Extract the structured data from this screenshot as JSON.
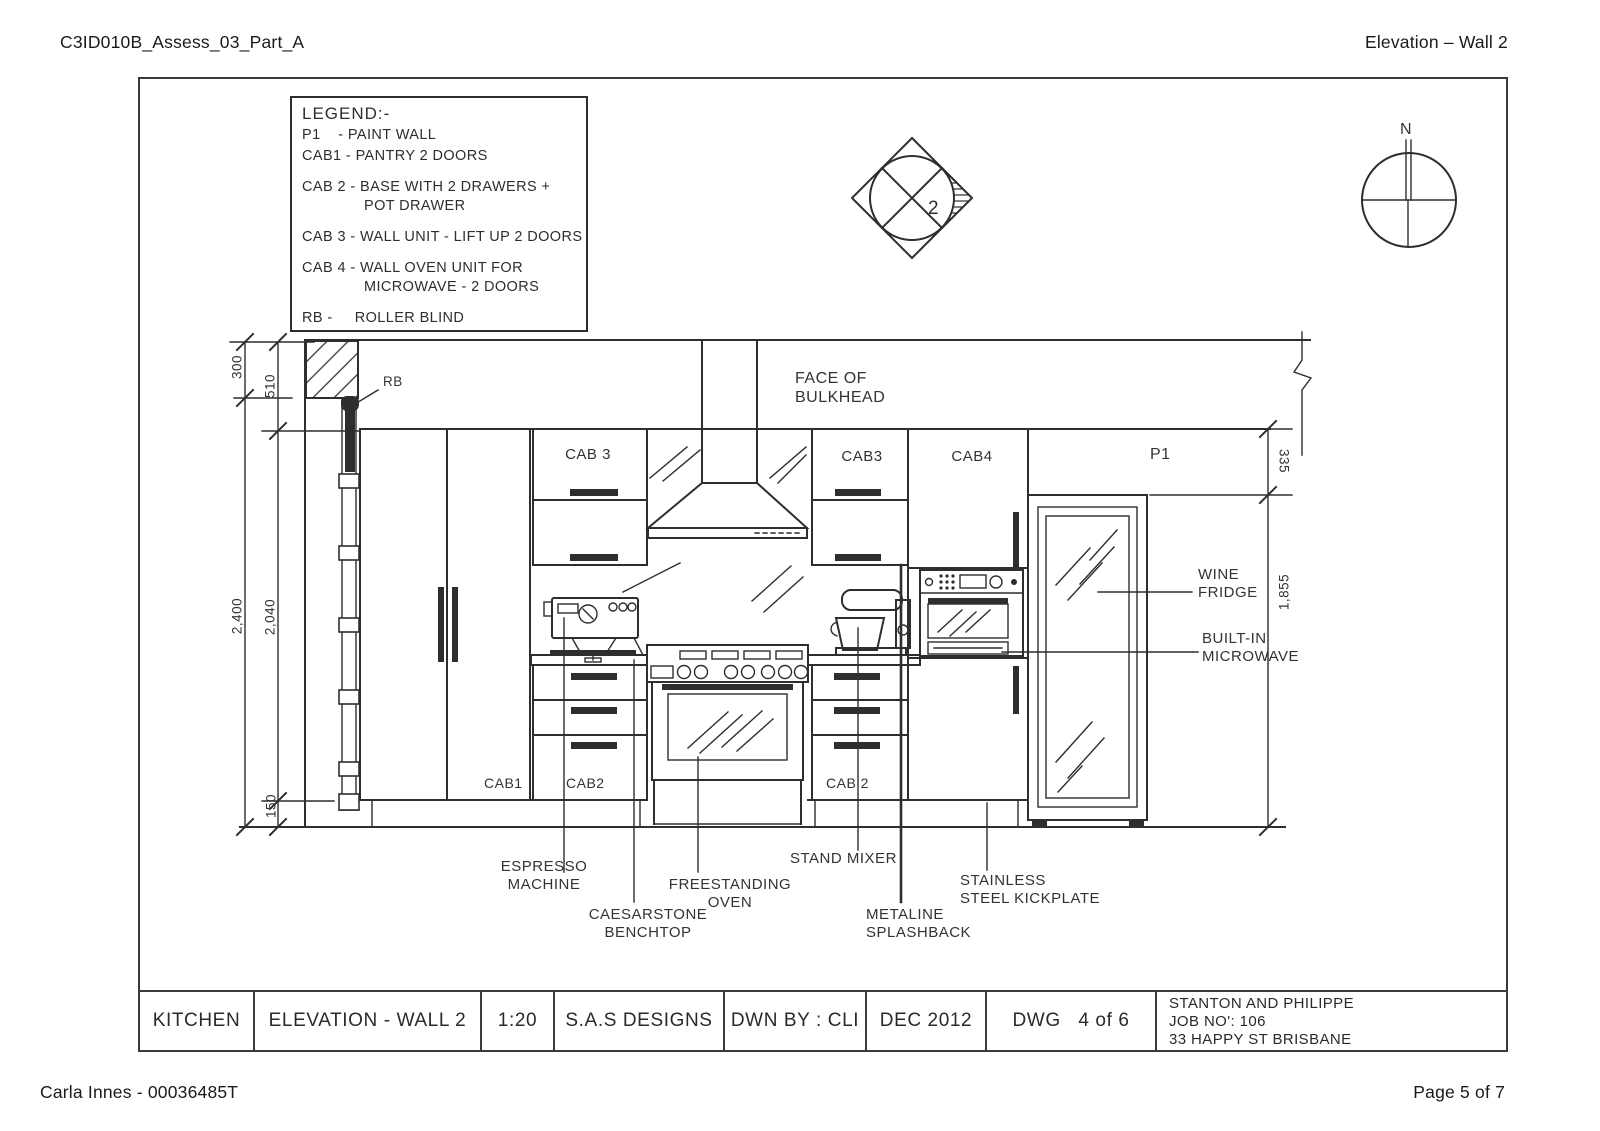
{
  "page": {
    "header_left": "C3ID010B_Assess_03_Part_A",
    "header_right": "Elevation – Wall 2",
    "footer_left": "Carla Innes - 00036485T",
    "footer_right": "Page 5 of 7"
  },
  "legend": {
    "title": "LEGEND:-",
    "entries": [
      {
        "text": "P1    - PAINT WALL"
      },
      {
        "text": "CAB1 - PANTRY 2 DOORS"
      },
      {
        "text": "CAB 2 - BASE WITH 2 DRAWERS +\n              POT DRAWER"
      },
      {
        "text": "CAB 3 - WALL UNIT - LIFT UP 2 DOORS"
      },
      {
        "text": "CAB 4 - WALL OVEN UNIT FOR\n              MICROWAVE - 2 DOORS"
      },
      {
        "text": "RB -     ROLLER BLIND"
      }
    ]
  },
  "markers": {
    "section_number": "2",
    "north_label": "N"
  },
  "dimensions": {
    "left_outer": [
      "300",
      "2,400"
    ],
    "left_inner": [
      "510",
      "2,040",
      "150"
    ],
    "right": [
      "335",
      "1,855"
    ]
  },
  "drawing_labels": {
    "rb": "RB",
    "face_of_bulkhead": "FACE OF\nBULKHEAD",
    "cab3_left": "CAB 3",
    "cab3_right": "CAB3",
    "cab4": "CAB4",
    "p1": "P1",
    "cab1": "CAB1",
    "cab2_left": "CAB2",
    "cab2_right": "CAB 2",
    "wine_fridge": "WINE\nFRIDGE",
    "built_in_microwave": "BUILT-IN\nMICROWAVE",
    "espresso_machine": "ESPRESSO\nMACHINE",
    "caesarstone_benchtop": "CAESARSTONE\nBENCHTOP",
    "freestanding_oven": "FREESTANDING\nOVEN",
    "stand_mixer": "STAND MIXER",
    "metaline_splashback": "METALINE\nSPLASHBACK",
    "stainless_kickplate": "STAINLESS\nSTEEL KICKPLATE"
  },
  "title_block": {
    "room": "KITCHEN",
    "view": "ELEVATION - WALL 2",
    "scale": "1:20",
    "firm": "S.A.S DESIGNS",
    "drawn_by": "DWN BY : CLI",
    "date": "DEC 2012",
    "sheet": "DWG   4 of 6",
    "client": "STANTON AND PHILIPPE",
    "job_no": "JOB NO': 106",
    "address": "33 HAPPY ST BRISBANE"
  }
}
